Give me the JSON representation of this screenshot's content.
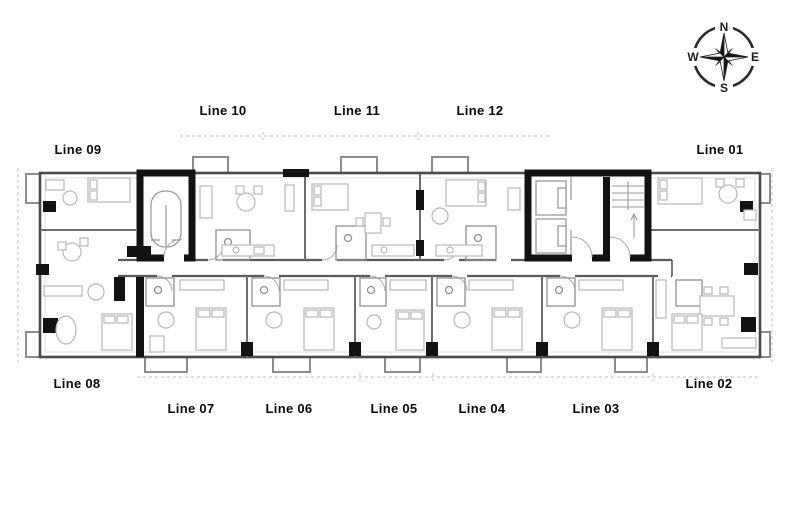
{
  "title": "Residential tower typical floor plan",
  "labels": {
    "line01": "Line 01",
    "line02": "Line 02",
    "line03": "Line 03",
    "line04": "Line 04",
    "line05": "Line 05",
    "line06": "Line 06",
    "line07": "Line 07",
    "line08": "Line 08",
    "line09": "Line 09",
    "line10": "Line 10",
    "line11": "Line 11",
    "line12": "Line 12"
  },
  "compass": {
    "north": "N",
    "east": "E",
    "south": "S",
    "west": "W"
  },
  "colors": {
    "wall": "#4a4a4a",
    "core_black": "#121212",
    "interior_wall": "#6e6e6e",
    "furniture": "#b8b8b8",
    "boundary_dash": "#bdbdbd"
  }
}
